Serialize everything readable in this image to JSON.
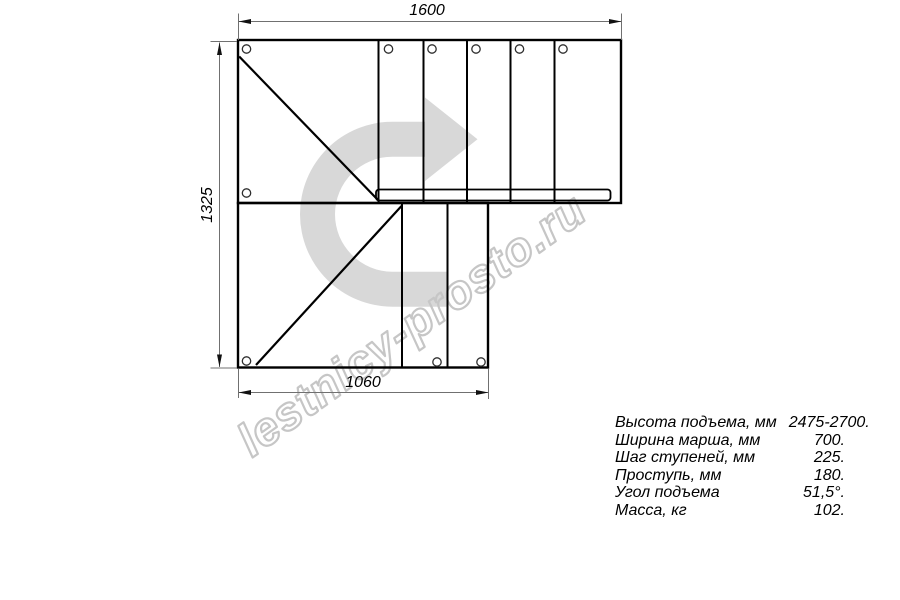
{
  "drawing": {
    "title": "staircase-plan",
    "dimensions": {
      "top": "1600",
      "left": "1325",
      "bottom": "1060"
    },
    "watermark": "lestnicy-prosto.ru",
    "icons": {
      "turn_arrow": "u-turn-right-arrow"
    },
    "colors": {
      "line": "#000000",
      "dimension_line": "#707070",
      "arrow_watermark": "#d8d8d8",
      "watermark_text_stroke": "#c6c6c6",
      "background": "#ffffff"
    }
  },
  "specs": {
    "rows": [
      {
        "label": "Высота подъема, мм",
        "value": "2475-2700."
      },
      {
        "label": "Ширина марша, мм",
        "value": "700."
      },
      {
        "label": "Шаг ступеней, мм",
        "value": "225."
      },
      {
        "label": "Проступь, мм",
        "value": "180."
      },
      {
        "label": "Угол подъема",
        "value": "51,5°."
      },
      {
        "label": "Масса, кг",
        "value": "102."
      }
    ]
  }
}
